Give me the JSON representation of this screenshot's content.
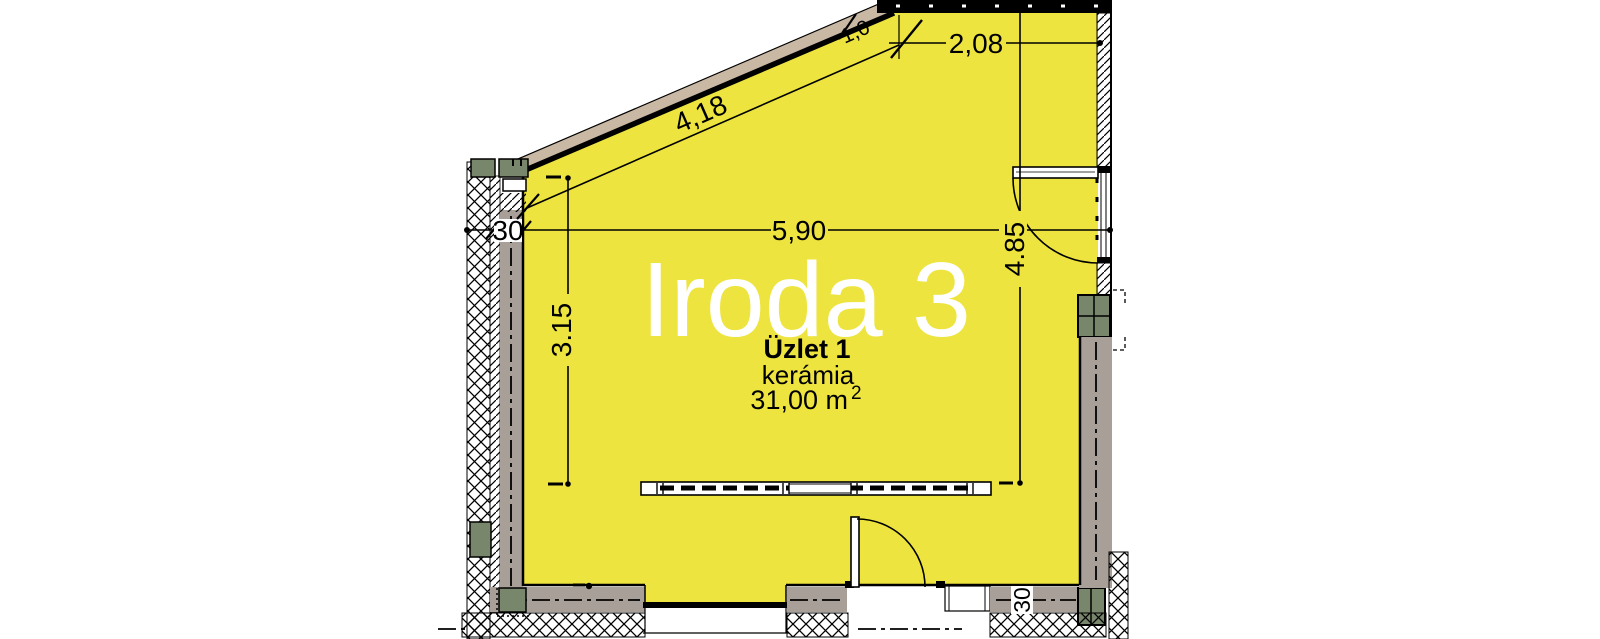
{
  "drawing": {
    "type": "architectural-floor-plan",
    "room": {
      "name": "Iroda 3"
    },
    "unit": {
      "name": "Üzlet 1",
      "material": "kerámia",
      "area_value": "31,00 m",
      "area_exponent": "2"
    },
    "dimensions": {
      "diagonal_wall_length": "4,18",
      "top_wall_segment": "2,08",
      "room_width": "5,90",
      "left_wall_thickness": "30",
      "room_depth_left": "3.15",
      "room_depth_right": "4.85",
      "bottom_wall_thickness": "30",
      "diagonal_offset": "1,0"
    },
    "colors": {
      "floor_yellow": "#EDE43F",
      "wall_gray": "#A89F99",
      "diagonal_wall_tan": "#C9B8A3",
      "lintel_green": "#78866B",
      "line_black": "#000000",
      "background_white": "#FFFFFF"
    }
  }
}
